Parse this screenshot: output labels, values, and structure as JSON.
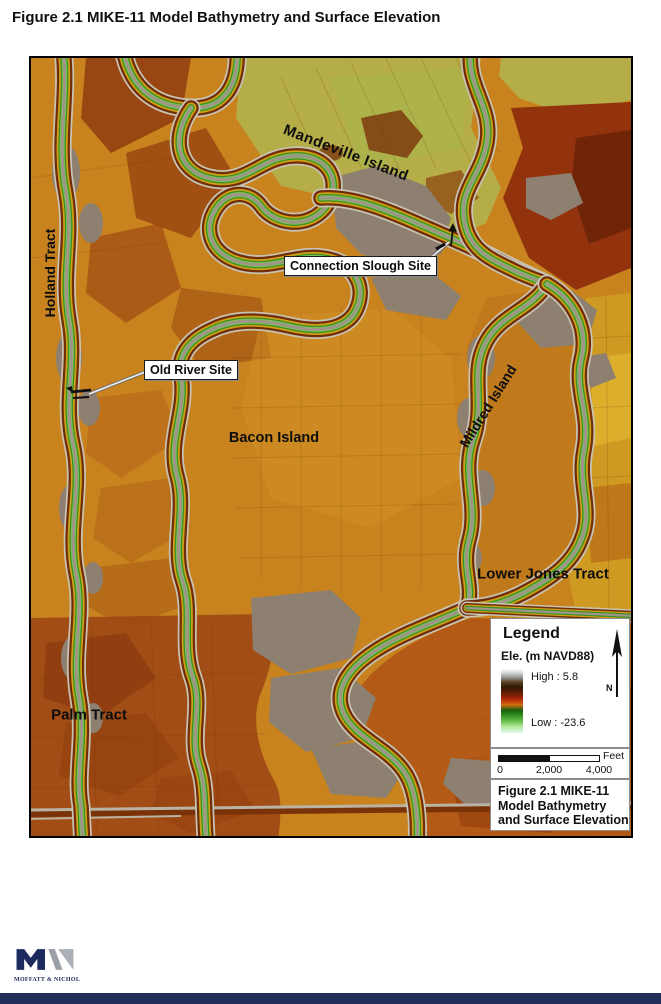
{
  "page": {
    "title": "Figure 2.1 MIKE-11 Model Bathymetry and Surface Elevation"
  },
  "map": {
    "labels": {
      "holland_tract": "Holland Tract",
      "mandeville_island": "Mandeville Island",
      "bacon_island": "Bacon Island",
      "mildred_island": "Mildred Island",
      "lower_jones_tract": "Lower Jones Tract",
      "palm_tract": "Palm Tract"
    },
    "callouts": {
      "connection_slough": "Connection Slough Site",
      "old_river": "Old River Site"
    }
  },
  "legend": {
    "title": "Legend",
    "subtitle": "Ele. (m NAVD88)",
    "high_label": "High : 5.8",
    "low_label": "Low : -23.6",
    "north_label": "N",
    "ramp_colors": [
      "#ffffff",
      "#8e8e8e",
      "#2f1604",
      "#8c2008",
      "#c03808",
      "#d2700e",
      "#1e5c10",
      "#2f8c1e",
      "#66bc48",
      "#b2e89a",
      "#e2fbee"
    ]
  },
  "scale_bar": {
    "unit": "Feet",
    "ticks": [
      "0",
      "2,000",
      "4,000"
    ]
  },
  "caption": {
    "lines": [
      "Figure 2.1 MIKE-11",
      "Model Bathymetry",
      "and Surface Elevation"
    ]
  },
  "footer": {
    "logo_text": "MOFFATT & NICHOL",
    "bar_color": "#232d5a"
  },
  "colors": {
    "land_orange": "#c8831e",
    "red_brown_fields": "#93330d",
    "mandeville_green": "#b4ad48",
    "mildred_flat": "#c0791b",
    "channel_water_gray": "#9d9689",
    "marsh_green": "#3b8f27"
  }
}
